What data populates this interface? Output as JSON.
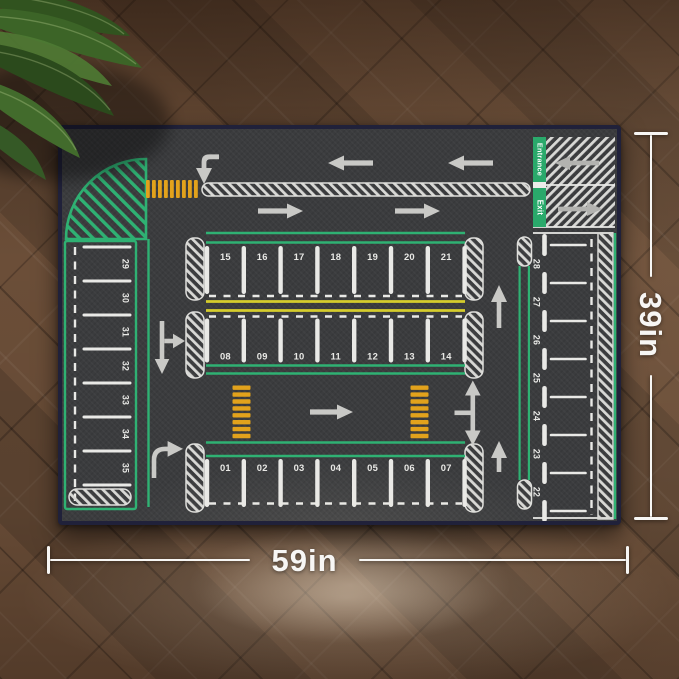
{
  "dimensions": {
    "width_label": "59in",
    "height_label": "39in"
  },
  "mat": {
    "entrance_label": "Entrance",
    "exit_label": "Exit",
    "spots": {
      "row_back": [
        "15",
        "16",
        "17",
        "18",
        "19",
        "20",
        "21"
      ],
      "row_middle": [
        "08",
        "09",
        "10",
        "11",
        "12",
        "13",
        "14"
      ],
      "row_front": [
        "01",
        "02",
        "03",
        "04",
        "05",
        "06",
        "07"
      ],
      "column_left_top_to_bottom": [
        "29",
        "30",
        "31",
        "32",
        "33",
        "34",
        "35"
      ],
      "column_right_top_to_bottom": [
        "28",
        "27",
        "26",
        "25",
        "24",
        "23",
        "22"
      ]
    },
    "icons": {
      "left_arrow": "←",
      "right_arrow": "→",
      "up_arrow": "↑",
      "turn_down_arrow": "⤵",
      "turn_right_arrow": "⤴",
      "two_way_branch_arrow": "⇅"
    },
    "colors": {
      "surface": "#3b3c3e",
      "binding": "#20213a",
      "marking_white": "#e9e9e6",
      "marking_green": "#2fb173",
      "arrow_gray": "#c9c9c6",
      "crosswalk_orange": "#e2a21c",
      "lane_yellow": "#d6cd2c"
    }
  },
  "annotation": {
    "color": "#f7f6f4"
  }
}
